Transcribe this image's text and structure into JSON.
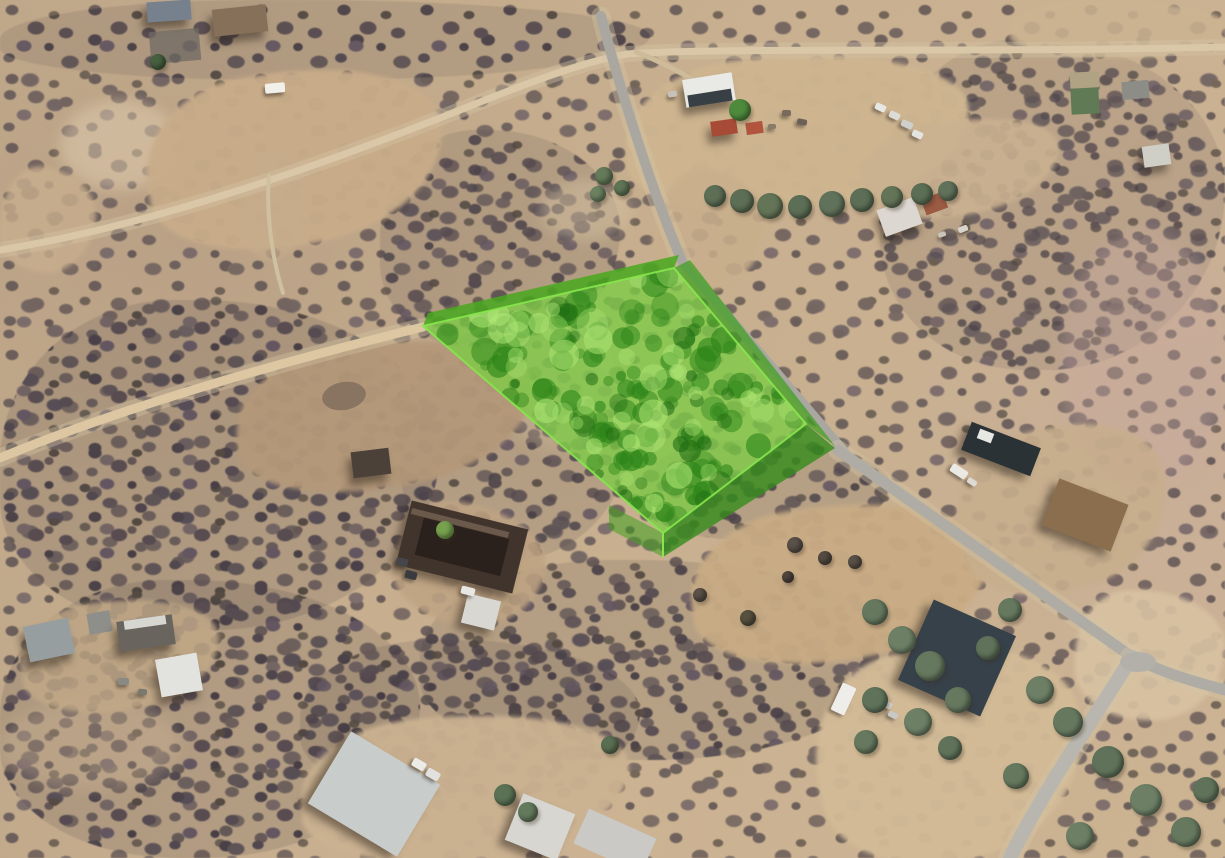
{
  "meta": {
    "title": "Oblique aerial satellite view of desert lots with a highlighted land parcel",
    "view_type": "aerial-satellite-3d"
  },
  "canvas": {
    "width": 1225,
    "height": 858
  },
  "palette": {
    "ground_tan": "#c6ae8e",
    "scrub_dark": "#524a50",
    "dirt_road": "#dcc7a2",
    "paved_road": "#aeaca4",
    "parcel_green_top": "#7dcd46",
    "parcel_green_wall": "#3fa01e",
    "parcel_edge": "#86e64c"
  },
  "parcel": {
    "top_face": [
      [
        423,
        326
      ],
      [
        674,
        268
      ],
      [
        806,
        424
      ],
      [
        663,
        533
      ]
    ],
    "back_band": [
      [
        423,
        326
      ],
      [
        674,
        268
      ],
      [
        679,
        255
      ],
      [
        428,
        313
      ]
    ],
    "east_wall": [
      [
        674,
        268
      ],
      [
        806,
        424
      ],
      [
        835,
        446
      ],
      [
        690,
        260
      ]
    ],
    "front_wall": [
      [
        806,
        424
      ],
      [
        663,
        533
      ],
      [
        663,
        557
      ],
      [
        835,
        448
      ]
    ],
    "sw_wall": [
      [
        609,
        505
      ],
      [
        663,
        533
      ],
      [
        663,
        557
      ],
      [
        609,
        529
      ]
    ],
    "corner_line": [
      [
        663,
        533
      ],
      [
        663,
        557
      ]
    ],
    "colors": {
      "top": "rgba(125,205,70,0.78)",
      "band": "rgba(73,168,31,0.85)",
      "east_wall": "rgba(63,160,30,0.72)",
      "front_wall": "rgba(53,140,28,0.8)",
      "sw_wall": "rgba(63,160,30,0.55)",
      "edge": "#86e64c",
      "blob_dark": "44,132,24",
      "blob_darker": "30,105,18",
      "blob_light": "176,232,118"
    }
  },
  "roads": [
    {
      "name": "dirt-road-top-left",
      "d": "M 0 250 C 150 226, 320 166, 465 108 C 540 78, 590 60, 628 54 C 720 47, 980 53, 1225 47",
      "color": "#d9c7a7",
      "width": 7,
      "halo": 1
    },
    {
      "name": "dirt-road-west",
      "d": "M 0 458 C 120 408, 280 362, 423 327",
      "color": "#dcc7a2",
      "width": 9,
      "halo": 1
    },
    {
      "name": "track-north-field",
      "d": "M 283 293 C 272 258, 266 214, 269 176",
      "color": "#cfc0a0",
      "width": 4,
      "halo": 0
    },
    {
      "name": "driveway-compound",
      "d": "M 636 52 C 662 62, 684 74, 700 84",
      "color": "#cdbb9a",
      "width": 5,
      "halo": 0
    },
    {
      "name": "paved-road-north",
      "d": "M 601 16 C 620 90, 655 200, 683 263",
      "color": "#a9a7a0",
      "width": 10,
      "halo": 1
    },
    {
      "name": "paved-road-parcel-edge",
      "d": "M 683 263 L 845 452",
      "color": "#a9a7a0",
      "width": 9,
      "halo": 0
    },
    {
      "name": "paved-road-south",
      "d": "M 838 450 L 1125 652 C 1150 668, 1180 678, 1225 690",
      "color": "#aeaca4",
      "width": 11,
      "halo": 1
    },
    {
      "name": "road-branch-bottom",
      "d": "M 1132 657 C 1090 725, 1042 792, 1010 858",
      "color": "#b8b6ae",
      "width": 14,
      "halo": 1
    }
  ],
  "junction": {
    "cx": 1138,
    "cy": 662,
    "rx": 18,
    "ry": 10,
    "color": "#b2b0a8"
  },
  "clearings": [
    {
      "name": "field-top-left",
      "x": 145,
      "y": 70,
      "w": 300,
      "h": 175,
      "rot": -10,
      "color": "#c9ad8a",
      "op": 0.95
    },
    {
      "name": "compound-yard",
      "x": 625,
      "y": 55,
      "w": 345,
      "h": 155,
      "rot": -5,
      "color": "#cfb691",
      "op": 0.97
    },
    {
      "name": "compound-yard-east",
      "x": 860,
      "y": 120,
      "w": 200,
      "h": 95,
      "rot": -10,
      "color": "#cab190",
      "op": 0.9
    },
    {
      "name": "roadside-strip",
      "x": 655,
      "y": 170,
      "w": 110,
      "h": 120,
      "rot": 12,
      "color": "#c9af8c",
      "op": 0.85
    },
    {
      "name": "field-mid-left",
      "x": 235,
      "y": 342,
      "w": 300,
      "h": 145,
      "rot": -9,
      "color": "#b49879",
      "op": 0.95
    },
    {
      "name": "clearing-left-edge",
      "x": 0,
      "y": 168,
      "w": 95,
      "h": 105,
      "rot": 8,
      "color": "#c8ae8d",
      "op": 0.8
    },
    {
      "name": "clearing-track-north",
      "x": 240,
      "y": 150,
      "w": 70,
      "h": 110,
      "rot": 5,
      "color": "#c6ac8b",
      "op": 0.7
    },
    {
      "name": "wash-below-parcel",
      "x": 690,
      "y": 505,
      "w": 300,
      "h": 155,
      "rot": -8,
      "color": "#c9ac85",
      "op": 0.95
    },
    {
      "name": "clearing-bottom-right",
      "x": 815,
      "y": 645,
      "w": 270,
      "h": 215,
      "rot": -12,
      "color": "#d3bb97",
      "op": 0.95
    },
    {
      "name": "clearing-right-mid",
      "x": 955,
      "y": 425,
      "w": 215,
      "h": 165,
      "rot": -18,
      "color": "#c7ae8d",
      "op": 0.9
    },
    {
      "name": "clearing-right-of-branch",
      "x": 1075,
      "y": 590,
      "w": 150,
      "h": 130,
      "rot": 0,
      "color": "#d8c2a2",
      "op": 0.9
    },
    {
      "name": "clearing-top-right",
      "x": 1010,
      "y": 0,
      "w": 215,
      "h": 58,
      "rot": 0,
      "color": "#ccb492",
      "op": 0.85
    },
    {
      "name": "clearing-bottom-center",
      "x": 300,
      "y": 715,
      "w": 330,
      "h": 145,
      "rot": -5,
      "color": "#cbb291",
      "op": 0.95
    },
    {
      "name": "clearing-house-center",
      "x": 395,
      "y": 505,
      "w": 150,
      "h": 120,
      "rot": 10,
      "color": "#bfa483",
      "op": 0.85
    },
    {
      "name": "clearing-bottom-left-sheds",
      "x": 20,
      "y": 600,
      "w": 200,
      "h": 110,
      "rot": -8,
      "color": "#c2a987",
      "op": 0.8
    }
  ],
  "dense_scrub": [
    {
      "x": 0,
      "y": 300,
      "w": 440,
      "h": 330,
      "op": 1
    },
    {
      "x": 0,
      "y": 580,
      "w": 420,
      "h": 278,
      "op": 1
    },
    {
      "x": 420,
      "y": 560,
      "w": 480,
      "h": 200,
      "op": 0.95
    },
    {
      "x": 300,
      "y": 640,
      "w": 340,
      "h": 160,
      "op": 0.9
    },
    {
      "x": 880,
      "y": 40,
      "w": 345,
      "h": 330,
      "op": 0.8
    },
    {
      "x": 0,
      "y": 0,
      "w": 650,
      "h": 80,
      "op": 0.85
    },
    {
      "x": 380,
      "y": 130,
      "w": 240,
      "h": 220,
      "op": 0.9
    },
    {
      "x": 400,
      "y": 330,
      "w": 230,
      "h": 230,
      "op": 0.9
    },
    {
      "x": 640,
      "y": 440,
      "w": 250,
      "h": 100,
      "op": 0.9
    }
  ],
  "light_patches": [
    {
      "x": 1060,
      "y": 230,
      "w": 165,
      "h": 260,
      "color": "rgba(200,170,160,0.35)"
    },
    {
      "x": 60,
      "y": 100,
      "w": 120,
      "h": 90,
      "color": "rgba(225,205,175,0.5)"
    },
    {
      "x": 500,
      "y": 330,
      "w": 120,
      "h": 120,
      "color": "rgba(210,190,160,0.3)"
    },
    {
      "x": 0,
      "y": 700,
      "w": 180,
      "h": 90,
      "color": "rgba(205,180,150,0.35)"
    },
    {
      "x": 540,
      "y": 180,
      "w": 90,
      "h": 60,
      "color": "rgba(215,195,165,0.45)"
    }
  ],
  "buildings": [
    {
      "name": "shed-topleft-blue",
      "x": 147,
      "y": 1,
      "w": 44,
      "h": 20,
      "rot": -4,
      "color": "#76818d",
      "sh": 1
    },
    {
      "name": "house-topleft-brown",
      "x": 213,
      "y": 7,
      "w": 54,
      "h": 27,
      "rot": -6,
      "color": "#87705a",
      "sh": 1
    },
    {
      "name": "gravel-patch",
      "x": 150,
      "y": 30,
      "w": 50,
      "h": 32,
      "rot": -5,
      "color": "#6f6963",
      "op": 0.75
    },
    {
      "name": "barn-compound",
      "x": 684,
      "y": 76,
      "w": 50,
      "h": 28,
      "rot": -9,
      "color": "#e9e9e5",
      "sh": 1
    },
    {
      "name": "barn-front",
      "x": 688,
      "y": 92,
      "w": 44,
      "h": 12,
      "rot": -9,
      "color": "#394045"
    },
    {
      "name": "shed-red-a",
      "x": 711,
      "y": 120,
      "w": 26,
      "h": 15,
      "rot": -8,
      "color": "#a84b36",
      "sh": 1
    },
    {
      "name": "shed-red-b",
      "x": 746,
      "y": 122,
      "w": 17,
      "h": 12,
      "rot": -8,
      "color": "#b2553e"
    },
    {
      "name": "house-compound-south",
      "x": 880,
      "y": 203,
      "w": 39,
      "h": 28,
      "rot": -20,
      "color": "#dcd8d1",
      "sh": 1
    },
    {
      "name": "shed-compound-red",
      "x": 923,
      "y": 195,
      "w": 23,
      "h": 17,
      "rot": -20,
      "color": "#9b5a42"
    },
    {
      "name": "shed-right-top-a",
      "x": 1070,
      "y": 72,
      "w": 29,
      "h": 16,
      "rot": -3,
      "color": "#b0a384"
    },
    {
      "name": "shed-right-top-b",
      "x": 1071,
      "y": 88,
      "w": 28,
      "h": 26,
      "rot": -3,
      "color": "#5f7a54"
    },
    {
      "name": "shed-right-top-c",
      "x": 1122,
      "y": 81,
      "w": 27,
      "h": 18,
      "rot": -5,
      "color": "#8d8d87"
    },
    {
      "name": "shed-right-mid",
      "x": 1143,
      "y": 145,
      "w": 27,
      "h": 21,
      "rot": -8,
      "color": "#cfcfc8",
      "sh": 1
    },
    {
      "name": "pond-dark",
      "x": 322,
      "y": 382,
      "w": 44,
      "h": 28,
      "rot": -10,
      "color": "#84705e",
      "round": 1,
      "op": 0.9
    },
    {
      "name": "shed-field",
      "x": 352,
      "y": 450,
      "w": 38,
      "h": 26,
      "rot": -7,
      "color": "#4b4138",
      "sh": 1
    },
    {
      "name": "shed-long-dark",
      "x": 964,
      "y": 434,
      "w": 74,
      "h": 30,
      "rot": 21,
      "color": "#2b3236",
      "sh": 1
    },
    {
      "name": "shed-long-dark-roofbit",
      "x": 978,
      "y": 431,
      "w": 15,
      "h": 10,
      "rot": 21,
      "color": "#e8e8e3"
    },
    {
      "name": "house-right-brown",
      "x": 1048,
      "y": 490,
      "w": 74,
      "h": 50,
      "rot": 21,
      "color": "#8a6e4d",
      "sh": 1
    },
    {
      "name": "house-center",
      "x": 402,
      "y": 514,
      "w": 120,
      "h": 66,
      "rot": 14,
      "color": "#40342c",
      "sh": 1
    },
    {
      "name": "house-center-roof-dark",
      "x": 418,
      "y": 528,
      "w": 88,
      "h": 38,
      "rot": 14,
      "color": "#2a211c"
    },
    {
      "name": "house-center-ridge",
      "x": 410,
      "y": 520,
      "w": 100,
      "h": 6,
      "rot": 14,
      "color": "#6b5a4b"
    },
    {
      "name": "shed-center-white",
      "x": 464,
      "y": 597,
      "w": 34,
      "h": 30,
      "rot": 14,
      "color": "#d8d7d2",
      "sh": 1
    },
    {
      "name": "shed-bl-gray",
      "x": 26,
      "y": 622,
      "w": 46,
      "h": 36,
      "rot": -12,
      "color": "#979ea0",
      "sh": 1
    },
    {
      "name": "shed-bl-small",
      "x": 88,
      "y": 612,
      "w": 23,
      "h": 21,
      "rot": -10,
      "color": "#8e8e8a"
    },
    {
      "name": "building-bl",
      "x": 118,
      "y": 618,
      "w": 56,
      "h": 30,
      "rot": -8,
      "color": "#6a645e",
      "sh": 1
    },
    {
      "name": "building-bl-white",
      "x": 124,
      "y": 618,
      "w": 42,
      "h": 9,
      "rot": -8,
      "color": "#d7d7d2"
    },
    {
      "name": "shed-bl-peaked",
      "x": 158,
      "y": 656,
      "w": 42,
      "h": 38,
      "rot": -10,
      "color": "#e2e2de",
      "sh": 1
    },
    {
      "name": "building-bc-grayroof",
      "x": 322,
      "y": 752,
      "w": 104,
      "h": 84,
      "rot": 31,
      "color": "#c8ccca",
      "sh": 1
    },
    {
      "name": "shed-bc-white",
      "x": 512,
      "y": 802,
      "w": 56,
      "h": 50,
      "rot": 22,
      "color": "#d7d6d1",
      "sh": 1
    },
    {
      "name": "building-bc2-white",
      "x": 578,
      "y": 822,
      "w": 74,
      "h": 38,
      "rot": 24,
      "color": "#cac9c5"
    },
    {
      "name": "building-br-dark",
      "x": 912,
      "y": 614,
      "w": 90,
      "h": 88,
      "rot": 24,
      "color": "#37414a",
      "sh": 1
    }
  ],
  "vehicles": [
    {
      "name": "trailer-topleft",
      "x": 265,
      "y": 83,
      "w": 20,
      "h": 10,
      "rot": -5,
      "color": "#f1f0eb"
    },
    {
      "name": "car",
      "x": 875,
      "y": 104,
      "w": 11,
      "h": 7,
      "rot": 25,
      "color": "#e7e7e3"
    },
    {
      "name": "car",
      "x": 889,
      "y": 112,
      "w": 11,
      "h": 7,
      "rot": 25,
      "color": "#dddbd6"
    },
    {
      "name": "car",
      "x": 901,
      "y": 121,
      "w": 12,
      "h": 7,
      "rot": 25,
      "color": "#cfd0cc"
    },
    {
      "name": "car",
      "x": 912,
      "y": 131,
      "w": 11,
      "h": 7,
      "rot": 25,
      "color": "#e3e3df"
    },
    {
      "name": "junk",
      "x": 782,
      "y": 110,
      "w": 9,
      "h": 6,
      "rot": 0,
      "color": "#7a6a5c"
    },
    {
      "name": "junk",
      "x": 797,
      "y": 119,
      "w": 10,
      "h": 6,
      "rot": 10,
      "color": "#6b6156"
    },
    {
      "name": "junk",
      "x": 768,
      "y": 124,
      "w": 8,
      "h": 5,
      "rot": 0,
      "color": "#8a7a68"
    },
    {
      "name": "car",
      "x": 668,
      "y": 91,
      "w": 9,
      "h": 6,
      "rot": -9,
      "color": "#c6c1b9"
    },
    {
      "name": "junk",
      "x": 958,
      "y": 226,
      "w": 10,
      "h": 6,
      "rot": -20,
      "color": "#d8d4cc"
    },
    {
      "name": "junk",
      "x": 938,
      "y": 232,
      "w": 8,
      "h": 5,
      "rot": -20,
      "color": "#c9c4ba"
    },
    {
      "name": "rv-right",
      "x": 950,
      "y": 467,
      "w": 18,
      "h": 9,
      "rot": 33,
      "color": "#ebe9e3"
    },
    {
      "name": "car",
      "x": 967,
      "y": 479,
      "w": 10,
      "h": 6,
      "rot": 33,
      "color": "#dcdad3"
    },
    {
      "name": "car-dark",
      "x": 396,
      "y": 558,
      "w": 12,
      "h": 8,
      "rot": 14,
      "color": "#46464a"
    },
    {
      "name": "car-dark",
      "x": 405,
      "y": 571,
      "w": 12,
      "h": 8,
      "rot": 14,
      "color": "#3a3b3f"
    },
    {
      "name": "truck-white",
      "x": 461,
      "y": 587,
      "w": 14,
      "h": 8,
      "rot": 14,
      "color": "#e7e7e3"
    },
    {
      "name": "rv-bottom",
      "x": 836,
      "y": 684,
      "w": 15,
      "h": 30,
      "rot": 25,
      "color": "#eeede9"
    },
    {
      "name": "car",
      "x": 872,
      "y": 690,
      "w": 11,
      "h": 7,
      "rot": 25,
      "color": "#e5e5e1"
    },
    {
      "name": "car",
      "x": 881,
      "y": 701,
      "w": 11,
      "h": 7,
      "rot": 25,
      "color": "#d8d8d4"
    },
    {
      "name": "car",
      "x": 888,
      "y": 712,
      "w": 10,
      "h": 6,
      "rot": 25,
      "color": "#c8c8c4"
    },
    {
      "name": "truck-white",
      "x": 412,
      "y": 760,
      "w": 14,
      "h": 9,
      "rot": 30,
      "color": "#ebebe7"
    },
    {
      "name": "truck-white",
      "x": 426,
      "y": 770,
      "w": 14,
      "h": 9,
      "rot": 30,
      "color": "#e1e1dd"
    },
    {
      "name": "junk",
      "x": 118,
      "y": 678,
      "w": 11,
      "h": 7,
      "rot": 0,
      "color": "#8a8a85"
    },
    {
      "name": "junk",
      "x": 138,
      "y": 689,
      "w": 9,
      "h": 6,
      "rot": 5,
      "color": "#79796f"
    }
  ],
  "trees": [
    {
      "x": 715,
      "y": 196,
      "r": 11,
      "color": "#5c6e55"
    },
    {
      "x": 742,
      "y": 201,
      "r": 12,
      "color": "#5c6e55"
    },
    {
      "x": 770,
      "y": 206,
      "r": 13,
      "color": "#637457"
    },
    {
      "x": 800,
      "y": 207,
      "r": 12,
      "color": "#5c6e55"
    },
    {
      "x": 832,
      "y": 204,
      "r": 13,
      "color": "#60725a"
    },
    {
      "x": 862,
      "y": 200,
      "r": 12,
      "color": "#5c6e55"
    },
    {
      "x": 892,
      "y": 197,
      "r": 11,
      "color": "#637457"
    },
    {
      "x": 922,
      "y": 194,
      "r": 11,
      "color": "#5c6e55"
    },
    {
      "x": 948,
      "y": 191,
      "r": 10,
      "color": "#60725a"
    },
    {
      "x": 740,
      "y": 110,
      "r": 11,
      "color": "#4e8a3c"
    },
    {
      "x": 158,
      "y": 62,
      "r": 8,
      "color": "#47603f"
    },
    {
      "x": 604,
      "y": 176,
      "r": 9,
      "color": "#647a58"
    },
    {
      "x": 598,
      "y": 194,
      "r": 8,
      "color": "#6b8160"
    },
    {
      "x": 622,
      "y": 188,
      "r": 8,
      "color": "#5f7556"
    },
    {
      "x": 445,
      "y": 530,
      "r": 9,
      "color": "#76a24e"
    },
    {
      "x": 875,
      "y": 612,
      "r": 13,
      "color": "#66795f"
    },
    {
      "x": 902,
      "y": 640,
      "r": 14,
      "color": "#6d8066"
    },
    {
      "x": 930,
      "y": 666,
      "r": 15,
      "color": "#66795f"
    },
    {
      "x": 875,
      "y": 700,
      "r": 13,
      "color": "#60735a"
    },
    {
      "x": 918,
      "y": 722,
      "r": 14,
      "color": "#6d8066"
    },
    {
      "x": 958,
      "y": 700,
      "r": 13,
      "color": "#66795f"
    },
    {
      "x": 988,
      "y": 648,
      "r": 12,
      "color": "#60735a"
    },
    {
      "x": 1010,
      "y": 610,
      "r": 12,
      "color": "#66795f"
    },
    {
      "x": 1040,
      "y": 690,
      "r": 14,
      "color": "#6d8066"
    },
    {
      "x": 1068,
      "y": 722,
      "r": 15,
      "color": "#66795f"
    },
    {
      "x": 1108,
      "y": 762,
      "r": 16,
      "color": "#60735a"
    },
    {
      "x": 1146,
      "y": 800,
      "r": 16,
      "color": "#6d8066"
    },
    {
      "x": 1186,
      "y": 832,
      "r": 15,
      "color": "#66795f"
    },
    {
      "x": 1206,
      "y": 790,
      "r": 13,
      "color": "#60735a"
    },
    {
      "x": 1080,
      "y": 836,
      "r": 14,
      "color": "#6d8066"
    },
    {
      "x": 1016,
      "y": 776,
      "r": 13,
      "color": "#66795f"
    },
    {
      "x": 950,
      "y": 748,
      "r": 12,
      "color": "#60735a"
    },
    {
      "x": 866,
      "y": 742,
      "r": 12,
      "color": "#66795f"
    },
    {
      "x": 795,
      "y": 545,
      "r": 8,
      "color": "#5a5148"
    },
    {
      "x": 825,
      "y": 558,
      "r": 7,
      "color": "#544b42"
    },
    {
      "x": 855,
      "y": 562,
      "r": 7,
      "color": "#5a5148"
    },
    {
      "x": 788,
      "y": 577,
      "r": 6,
      "color": "#4f463e"
    },
    {
      "x": 748,
      "y": 618,
      "r": 8,
      "color": "#57503f"
    },
    {
      "x": 700,
      "y": 595,
      "r": 7,
      "color": "#5a5148"
    },
    {
      "x": 505,
      "y": 795,
      "r": 11,
      "color": "#5c7254"
    },
    {
      "x": 528,
      "y": 812,
      "r": 10,
      "color": "#647a5c"
    },
    {
      "x": 610,
      "y": 745,
      "r": 9,
      "color": "#5a6e52"
    }
  ]
}
